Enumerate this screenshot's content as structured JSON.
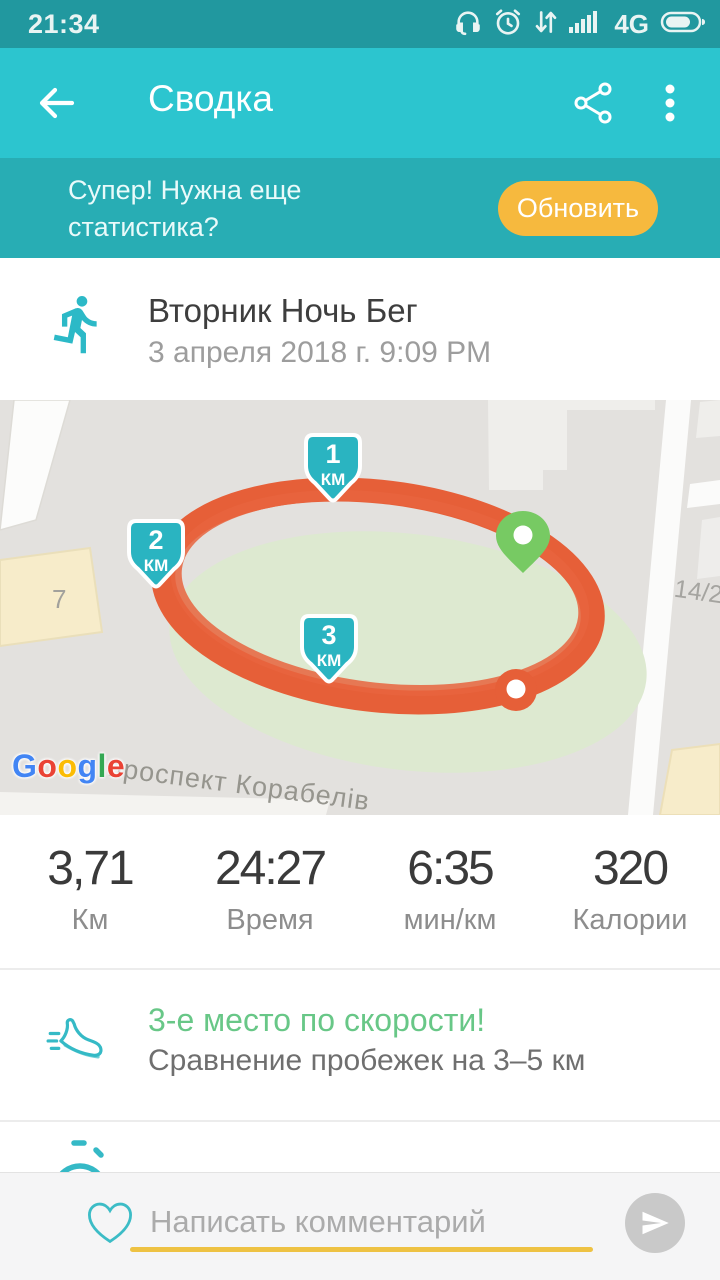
{
  "status_bar": {
    "time": "21:34",
    "network_label": "4G"
  },
  "app_bar": {
    "title": "Сводка"
  },
  "banner": {
    "message": "Супер! Нужна еще статистика?",
    "button_label": "Обновить"
  },
  "activity": {
    "title": "Вторник Ночь Бег",
    "datetime": "3 апреля 2018 г. 9:09 PM"
  },
  "map": {
    "attribution_letters": [
      "G",
      "o",
      "o",
      "g",
      "l",
      "e"
    ],
    "street_label": "проспект Корабелів",
    "building_label_left": "7",
    "building_label_right": "14/2",
    "markers": [
      {
        "value": "1",
        "unit": "КМ"
      },
      {
        "value": "2",
        "unit": "КМ"
      },
      {
        "value": "3",
        "unit": "КМ"
      }
    ]
  },
  "stats": [
    {
      "value": "3,71",
      "label": "Км"
    },
    {
      "value": "24:27",
      "label": "Время"
    },
    {
      "value": "6:35",
      "label": "мин/км"
    },
    {
      "value": "320",
      "label": "Калории"
    }
  ],
  "achievement": {
    "title": "3-е место по скорости!",
    "subtitle": "Сравнение пробежек на 3–5 км"
  },
  "comment": {
    "placeholder": "Написать комментарий"
  },
  "colors": {
    "status_bar": "#21989f",
    "app_bar": "#2cc5cf",
    "banner": "#28adb4",
    "accent_button": "#f6b93e",
    "route": "#e65f38",
    "km_marker": "#2ab4c1",
    "start_pin": "#77ca63",
    "achievement_green": "#68c787",
    "underline": "#eec243",
    "icon_teal": "#2cb9c7"
  }
}
